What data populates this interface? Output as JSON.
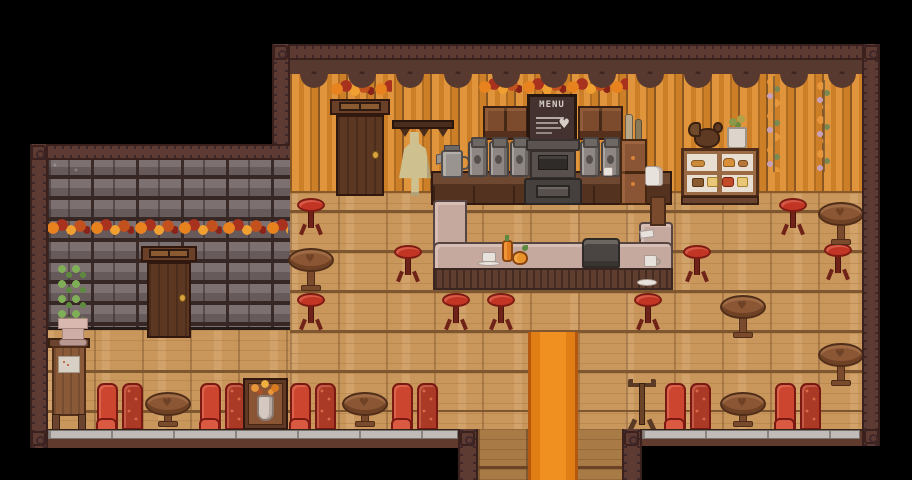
{
  "scene": {
    "title": "Autumn cafe interior — pixel-art game scene",
    "style": "top-down pixel RPG cafe decorated for fall"
  },
  "signs": {
    "menu_board": {
      "text": "MENU",
      "heart_glyph": "♥"
    }
  },
  "palette": {
    "background": "#000000",
    "frame_wood": "#5d3b33",
    "valance": "#57392f",
    "wall_stripe_light": "#e0953c",
    "wall_stripe_dark": "#cd7f28",
    "stone_wall": "#362725",
    "stone_brick_light": "#7d7070",
    "stone_brick_dark": "#665a5a",
    "floor": "#c9975c",
    "floor_line": "#7e5630",
    "corridor_floor": "#a87a45",
    "carpet_orange": "#ef9021",
    "carpet_border": "#e07d15",
    "stool_red": "#c23524",
    "booth_red": "#cc452e",
    "booth_red_dark": "#aa3a26",
    "table_wood": "#8a5634",
    "bar_surface": "#c5a89e",
    "bar_front": "#5f3d2f",
    "counter_wood": "#6f4832",
    "machine_gray": "#57504c",
    "canister_gray": "#8d8683",
    "baseboard_gray": "#c2bcb8",
    "garland_orange": "#e8821e",
    "garland_red": "#a8321e",
    "garland_yellow": "#f0a030",
    "door_wood": "#5c3722",
    "apron_beige": "#cfc090"
  },
  "furniture": {
    "stools": [
      [
        296,
        198
      ],
      [
        778,
        198
      ],
      [
        393,
        245
      ],
      [
        682,
        245
      ],
      [
        823,
        243
      ],
      [
        296,
        293
      ],
      [
        441,
        293
      ],
      [
        486,
        293
      ],
      [
        633,
        293
      ]
    ],
    "wood_tables": [
      [
        288,
        248
      ],
      [
        818,
        202
      ],
      [
        720,
        295
      ],
      [
        818,
        343
      ]
    ],
    "booth_tables": [
      [
        145,
        392
      ],
      [
        342,
        392
      ],
      [
        720,
        392
      ]
    ],
    "booths": [
      [
        97,
        383
      ],
      [
        200,
        383
      ],
      [
        290,
        383
      ],
      [
        392,
        383
      ],
      [
        665,
        383
      ],
      [
        775,
        383
      ]
    ]
  },
  "objects": {
    "menu_board": "chalkboard menu sign",
    "upper_door": "back-room door",
    "left_door": "side-room door",
    "bar_counter": "U-shaped service bar",
    "cash_register": "cash register on bar",
    "espresso_machine": "espresso machine / stove",
    "coffee_pot": "metal coffee pot",
    "coffee_canisters": "coffee canisters",
    "bakery_case": "bakery display case with pastries",
    "chicken_statue": "wooden chicken statue",
    "apron": "hanging apron",
    "plant": "potted plant",
    "flower_case": "flower vase display",
    "menu_stand": "standing menu board",
    "coat_rack": "coat rack",
    "carpet": "orange entrance runner rug",
    "garlands": "autumn leaf garlands"
  }
}
